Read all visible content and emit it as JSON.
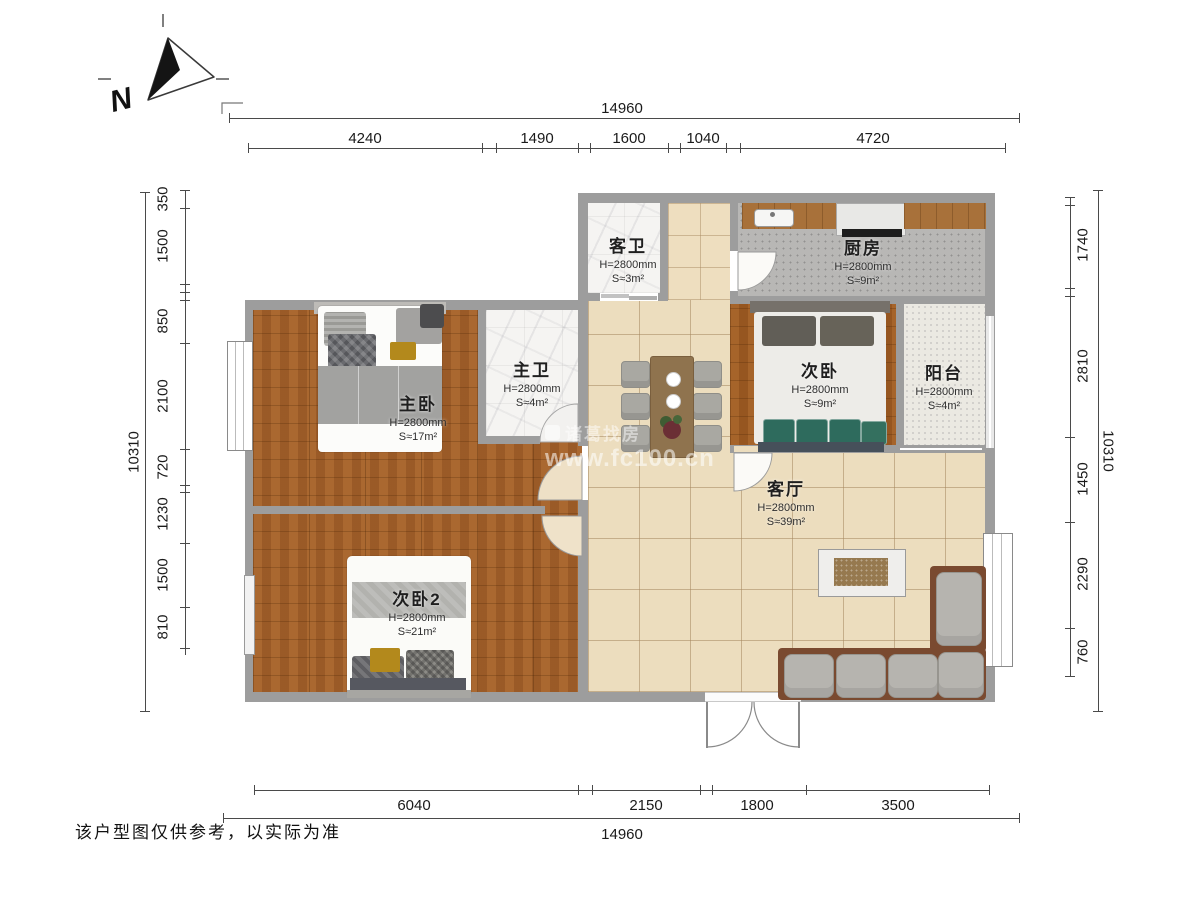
{
  "compass": {
    "north_label": "N"
  },
  "dimensions": {
    "top": {
      "total": "14960",
      "segments": [
        "4240",
        "1490",
        "1600",
        "1040",
        "4720"
      ]
    },
    "bottom": {
      "total": "14960",
      "segments": [
        "6040",
        "2150",
        "1800",
        "3500"
      ]
    },
    "left": {
      "total": "10310",
      "segments": [
        "350",
        "1500",
        "850",
        "2100",
        "720",
        "1230",
        "1500",
        "810"
      ]
    },
    "right": {
      "total": "10310",
      "segments": [
        "1740",
        "2810",
        "1450",
        "2290",
        "760"
      ]
    }
  },
  "rooms": {
    "guest_bath": {
      "name": "客卫",
      "height": "H=2800mm",
      "area": "S≈3m²"
    },
    "kitchen": {
      "name": "厨房",
      "height": "H=2800mm",
      "area": "S≈9m²"
    },
    "master_bath": {
      "name": "主卫",
      "height": "H=2800mm",
      "area": "S≈4m²"
    },
    "master_bedroom": {
      "name": "主卧",
      "height": "H=2800mm",
      "area": "S≈17m²"
    },
    "second_bedroom": {
      "name": "次卧",
      "height": "H=2800mm",
      "area": "S≈9m²"
    },
    "balcony": {
      "name": "阳台",
      "height": "H=2800mm",
      "area": "S≈4m²"
    },
    "living_room": {
      "name": "客厅",
      "height": "H=2800mm",
      "area": "S≈39m²"
    },
    "second_bedroom2": {
      "name": "次卧2",
      "height": "H=2800mm",
      "area": "S≈21m²"
    }
  },
  "watermark": {
    "brand": "诸葛找房",
    "url": "www.fc100.cn"
  },
  "footer": {
    "disclaimer": "该户型图仅供参考，以实际为准"
  },
  "colors": {
    "wall": "#9d9d9d",
    "wood_floor": "#a4612a",
    "tile_floor": "#ecddbe",
    "cushion_green": "#2e6b5d",
    "sofa_base": "#7a4a30",
    "accent_yellow": "#b3891c"
  }
}
